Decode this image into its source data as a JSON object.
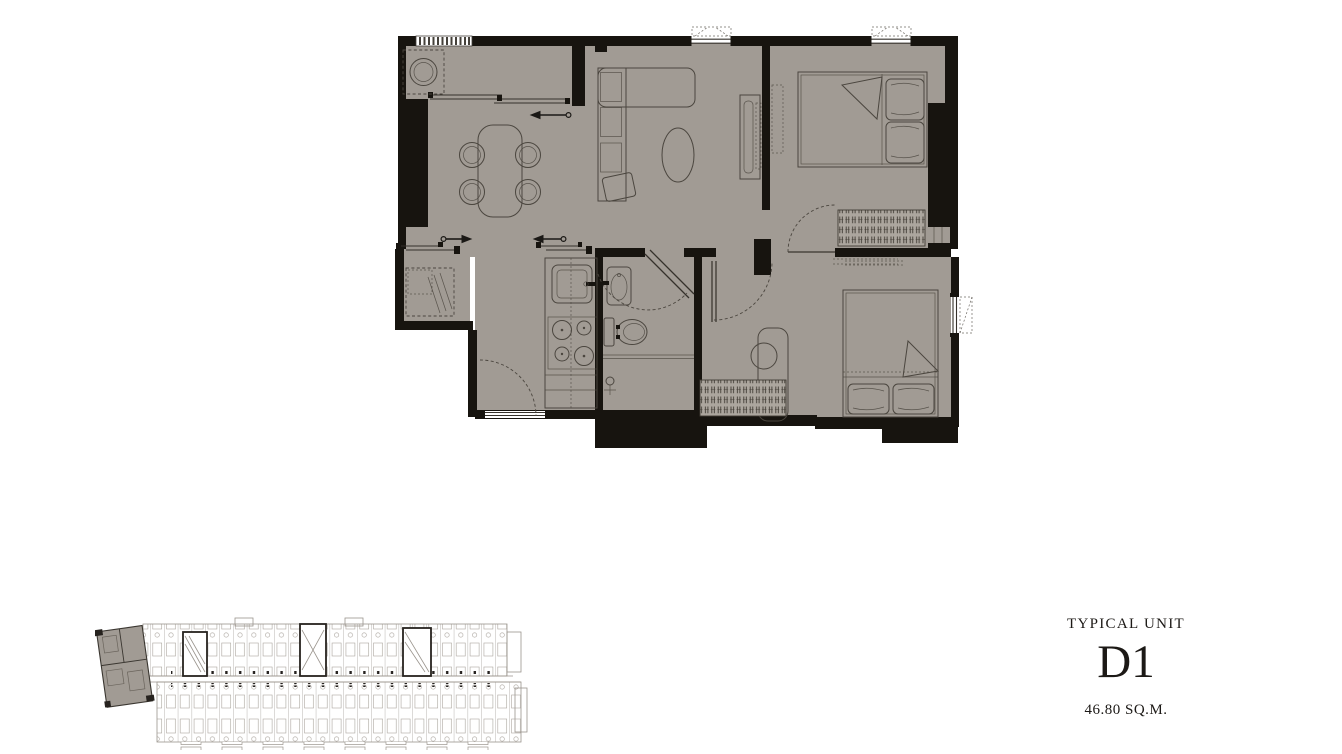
{
  "unit_label": {
    "title": "TYPICAL UNIT",
    "code": "D1",
    "area": "46.80 SQ.M."
  },
  "colors": {
    "background": "#ffffff",
    "floor": "#a19b94",
    "floor_light": "#aca69e",
    "wall": "#17140f",
    "furniture_line": "#4b463f",
    "keyplan_line": "#9a948d",
    "keyplan_bold": "#26221e",
    "text": "#1c1916"
  },
  "icons": {
    "main_plan": "unit-floor-plan",
    "key_plan": "building-key-plan",
    "highlight": "unit-location-highlight"
  }
}
